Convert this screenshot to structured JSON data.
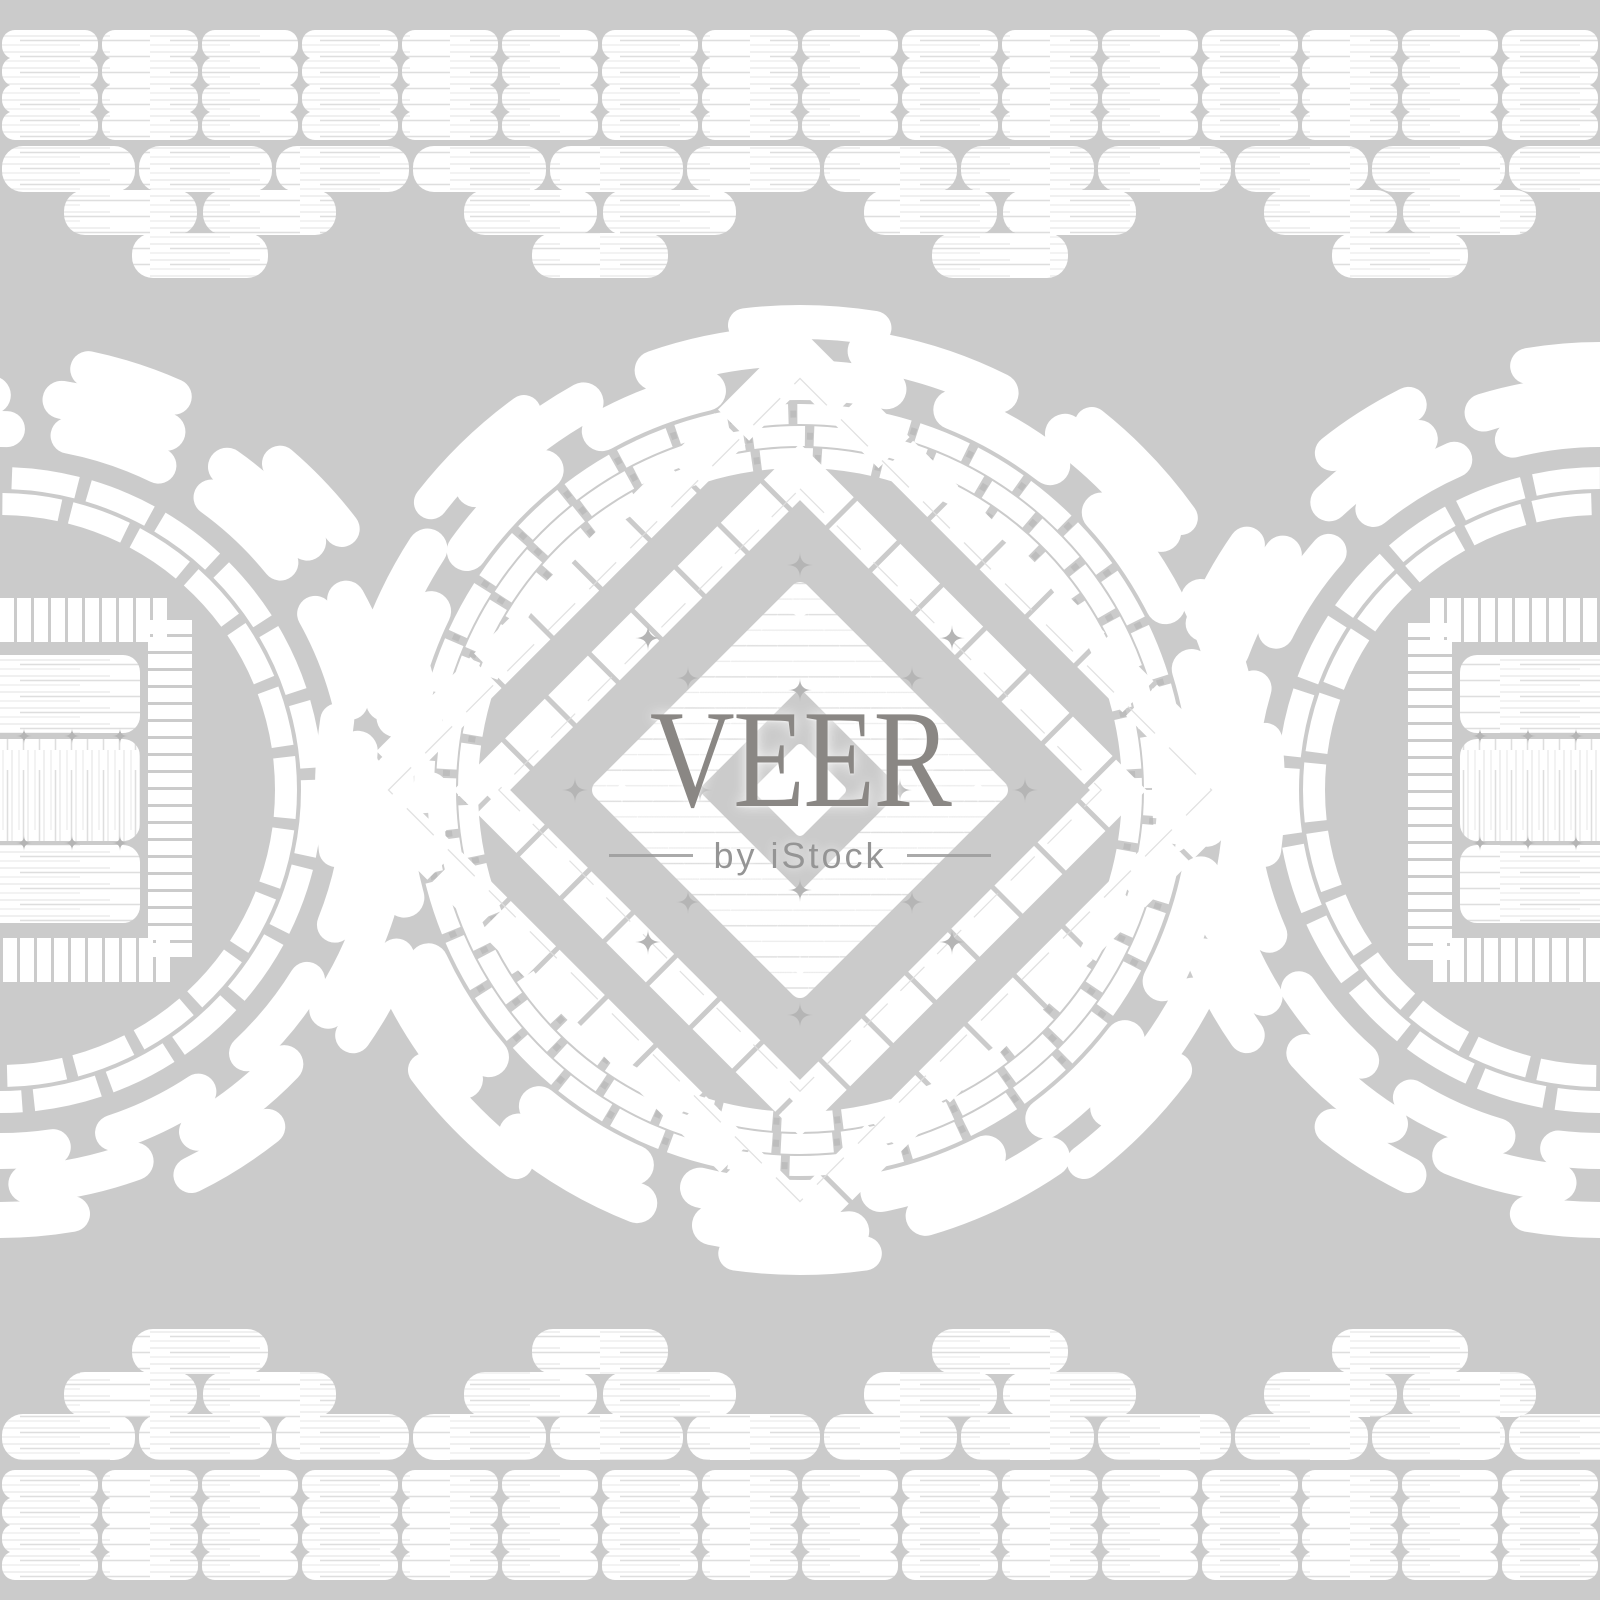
{
  "image": {
    "width": 1600,
    "height": 1600,
    "kind": "embroidery-seamless-pattern-stock-image"
  },
  "colors": {
    "background": "#cbcbcb",
    "motif": "#ffffff",
    "streak": "#dedede",
    "streak_soft": "#ececec",
    "sparkle": "#b5b5b5",
    "watermark_title": "#8a8784",
    "watermark_subtitle": "#959595",
    "watermark_line": "#9b9b9b"
  },
  "watermark": {
    "title": "VEER",
    "subtitle": "by iStock"
  },
  "ornament": {
    "solid_band": {
      "rows": 4,
      "row_pitch": 27,
      "brick_w": 96,
      "brick_h": 29,
      "pitch": 100,
      "radius": 13,
      "cols": 16,
      "top_y": 30,
      "bottom_y": 1470
    },
    "step_band": {
      "brick_h": 46,
      "pitch": 137,
      "radius": 21,
      "pyramid_centers": [
        200,
        600,
        1000,
        1400
      ],
      "top": {
        "full_y": 146,
        "tier2_y": 190,
        "tier3_y": 233
      },
      "bottom": {
        "full_y": 1414,
        "tier2_y": 1372,
        "tier3_y": 1329
      }
    },
    "center_medallion": {
      "cx": 800,
      "cy": 790,
      "chunky": [
        {
          "r": 468,
          "w": 34,
          "dash": "130 240",
          "off": -670
        },
        {
          "r": 444,
          "w": 40,
          "dash": "138 78",
          "off": 0
        },
        {
          "r": 410,
          "w": 40,
          "dash": "112 70",
          "off": 95
        }
      ],
      "fine": [
        {
          "r": 376,
          "w": 20,
          "dash": "52 9",
          "off": 0
        },
        {
          "r": 354,
          "w": 20,
          "dash": "52 9",
          "off": 26
        },
        {
          "r": 332,
          "w": 20,
          "dash": "52 9",
          "off": 0
        }
      ],
      "fine_tick": {
        "dash": "6 55",
        "w": 7,
        "rel_off": -54
      },
      "diamond": {
        "ringA_half": 305,
        "ringA_w": 44,
        "ringA_dash": "64 5",
        "ringB_half": 225,
        "ringB_w": 40,
        "ringB_dash": "56 5",
        "inner_half": 150,
        "hole_half": 72,
        "dot_half": 34
      }
    },
    "side_medallions": {
      "cy": 790,
      "cx": [
        0,
        1600
      ],
      "chunky": [
        {
          "r": 430,
          "w": 36,
          "dash": "90 126"
        },
        {
          "r": 395,
          "w": 38,
          "dash": "110 70"
        },
        {
          "r": 361,
          "w": 36,
          "dash": "95 62"
        }
      ],
      "fine": [
        {
          "r": 312,
          "w": 22,
          "dash": "66 12",
          "off": 0
        },
        {
          "r": 286,
          "w": 22,
          "dash": "58 11",
          "off": 30
        }
      ],
      "square": {
        "ring_half": 170,
        "ring_w": 44,
        "ring_dash": "14 3",
        "block_half_w": 140,
        "row_radius": 17,
        "rows": [
          {
            "y": 655,
            "h": 78,
            "tex": "h"
          },
          {
            "y": 739,
            "h": 102,
            "tex": "v"
          },
          {
            "y": 845,
            "h": 78,
            "tex": "h"
          }
        ]
      }
    }
  }
}
